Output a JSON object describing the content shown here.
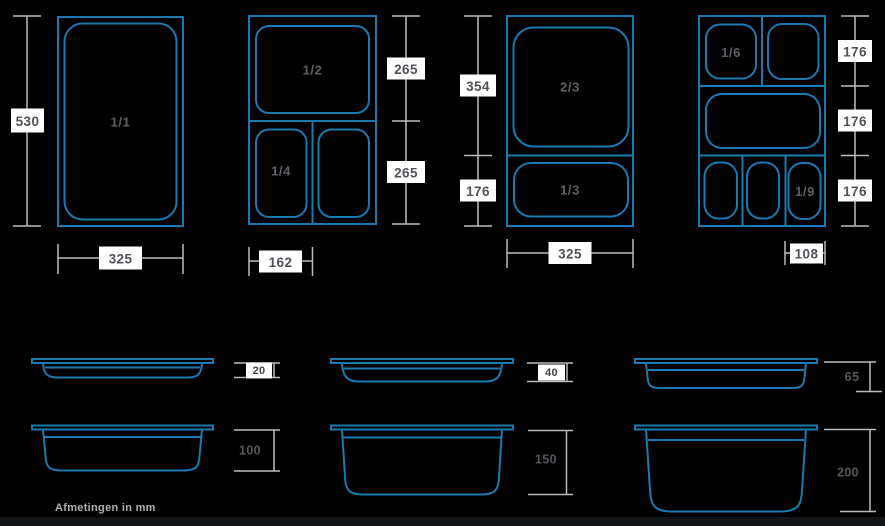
{
  "note": "Afmetingen in mm",
  "colors": {
    "background": "#000000",
    "pan_stroke": "#1b79b0",
    "dimension_line": "#b9bcbe",
    "label_box_bg": "#ffffff",
    "dimension_text": "#4f5357",
    "pan_label_text": "#5d6165"
  },
  "top_views": [
    {
      "name": "GN 1/1 pan (top view)",
      "labels": {
        "main": "1/1"
      },
      "dim_height": "530",
      "dim_width": "325"
    },
    {
      "name": "GN 1/2 + 1/4 pans (top view)",
      "labels": {
        "half": "1/2",
        "quarter": "1/4"
      },
      "dim_top": "265",
      "dim_bottom": "265",
      "dim_width": "162"
    },
    {
      "name": "GN 2/3 + 1/3 pans (top view)",
      "labels": {
        "two_thirds": "2/3",
        "one_third": "1/3"
      },
      "dim_top": "354",
      "dim_bottom": "176",
      "dim_width": "325"
    },
    {
      "name": "GN 1/6 + 1/9 pans (top view)",
      "labels": {
        "sixth": "1/6",
        "ninth": "1/9"
      },
      "dim_row1": "176",
      "dim_row2": "176",
      "dim_row3": "176",
      "dim_width": "108"
    }
  ],
  "side_views": [
    {
      "name": "pan depth 20 mm",
      "depth": "20"
    },
    {
      "name": "pan depth 40 mm",
      "depth": "40"
    },
    {
      "name": "pan depth 65 mm",
      "depth": "65"
    },
    {
      "name": "pan depth 100 mm",
      "depth": "100"
    },
    {
      "name": "pan depth 150 mm",
      "depth": "150"
    },
    {
      "name": "pan depth 200 mm",
      "depth": "200"
    }
  ]
}
